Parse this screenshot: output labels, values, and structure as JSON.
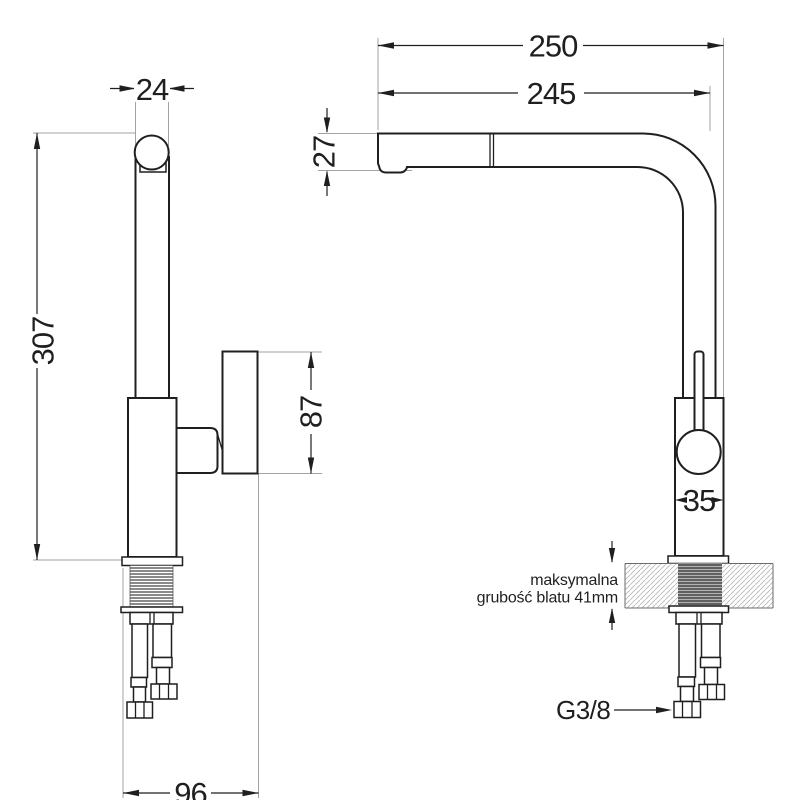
{
  "drawing": {
    "title": "faucet dimension drawing",
    "dimensions": {
      "front": {
        "spout_top_diameter": "24",
        "total_height": "307",
        "handle_length": "87",
        "base_depth": "96"
      },
      "side": {
        "reach_total": "250",
        "reach_spout": "245",
        "spout_tip_height": "27",
        "body_diameter": "35"
      }
    },
    "labels": {
      "countertop_line1": "maksymalna",
      "countertop_line2": "grubość blatu 41mm",
      "connection_thread": "G3/8"
    },
    "colors": {
      "line": "#1f1f1f",
      "extension_line": "#a3a3a3",
      "hatch": "#b9b9b9",
      "thread_dark": "#3c3c3c",
      "thread_bg": "#b3b3b3"
    }
  }
}
